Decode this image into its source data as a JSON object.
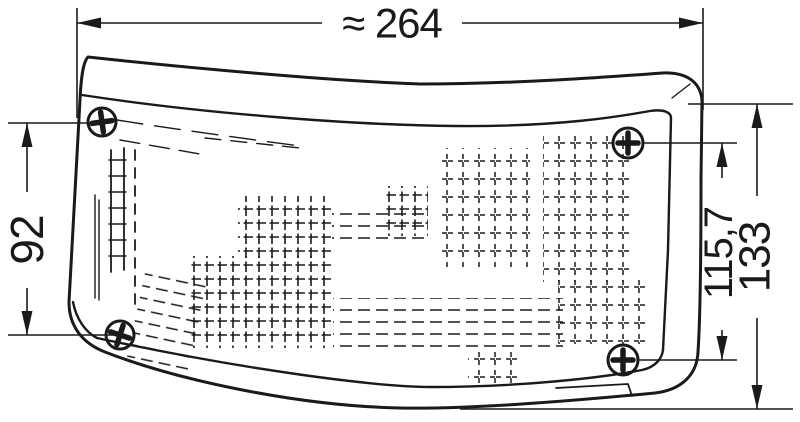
{
  "drawing": {
    "type": "technical-dimension-drawing",
    "subject": "vehicle lamp lens with mounting screws",
    "dimensions": {
      "width_top": {
        "label": "≈ 264",
        "orientation": "horizontal"
      },
      "height_left": {
        "label": "92",
        "orientation": "vertical-rotated"
      },
      "height_inner": {
        "label": "115,7",
        "orientation": "vertical-rotated"
      },
      "height_outer": {
        "label": "133",
        "orientation": "vertical-rotated"
      }
    },
    "screws": [
      {
        "name": "top-left"
      },
      {
        "name": "top-right"
      },
      {
        "name": "bottom-left"
      },
      {
        "name": "bottom-right"
      }
    ]
  },
  "colors": {
    "line": "#1a1a1a",
    "background": "#ffffff"
  }
}
